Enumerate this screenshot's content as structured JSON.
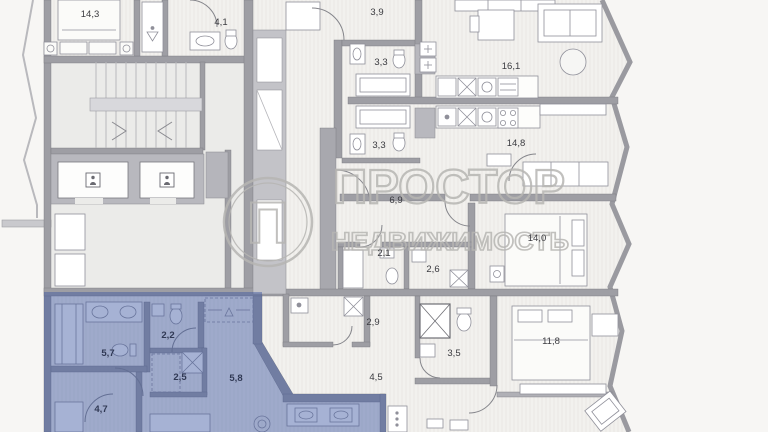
{
  "watermark": {
    "logo_letter": "П",
    "title": "ПРОСТОР",
    "subtitle": "НЕДВИЖИМОСТЬ"
  },
  "colors": {
    "background": "#f7f6f4",
    "floor": "#f2f1ee",
    "wall": "#9e9ea4",
    "core_fill": "#c3c3c8",
    "highlight_overlay": "#3a55a0",
    "label_text": "#3b3b40",
    "label_text_highlight": "#1d2640",
    "watermark": "#b7b6b3"
  },
  "rooms": [
    {
      "name": "bedroom-top-left",
      "area": "14,3"
    },
    {
      "name": "bathroom-top-left",
      "area": "4,1"
    },
    {
      "name": "hall-apartment-a",
      "area": "3,9"
    },
    {
      "name": "bathroom-apartment-a",
      "area": "3,3"
    },
    {
      "name": "bathroom-apartment-b",
      "area": "3,3"
    },
    {
      "name": "living-room-apartment-a",
      "area": "16,1"
    },
    {
      "name": "living-room-apartment-b",
      "area": "14,8"
    },
    {
      "name": "hall-apartment-c",
      "area": "6,9"
    },
    {
      "name": "bathroom-apartment-c-1",
      "area": "2,1"
    },
    {
      "name": "bathroom-apartment-c-2",
      "area": "2,6"
    },
    {
      "name": "bedroom-apartment-c",
      "area": "14,0"
    },
    {
      "name": "laundry-apartment-d",
      "area": "2,9"
    },
    {
      "name": "bathroom-apartment-d",
      "area": "3,5"
    },
    {
      "name": "hall-apartment-d",
      "area": "4,5"
    },
    {
      "name": "bedroom-apartment-d",
      "area": "11,8"
    },
    {
      "name": "bathroom-highlighted",
      "area": "5,7"
    },
    {
      "name": "wc-highlighted",
      "area": "2,2"
    },
    {
      "name": "utility-highlighted",
      "area": "2,5"
    },
    {
      "name": "hall-highlighted",
      "area": "5,8"
    },
    {
      "name": "room-highlighted",
      "area": "4,7"
    }
  ]
}
